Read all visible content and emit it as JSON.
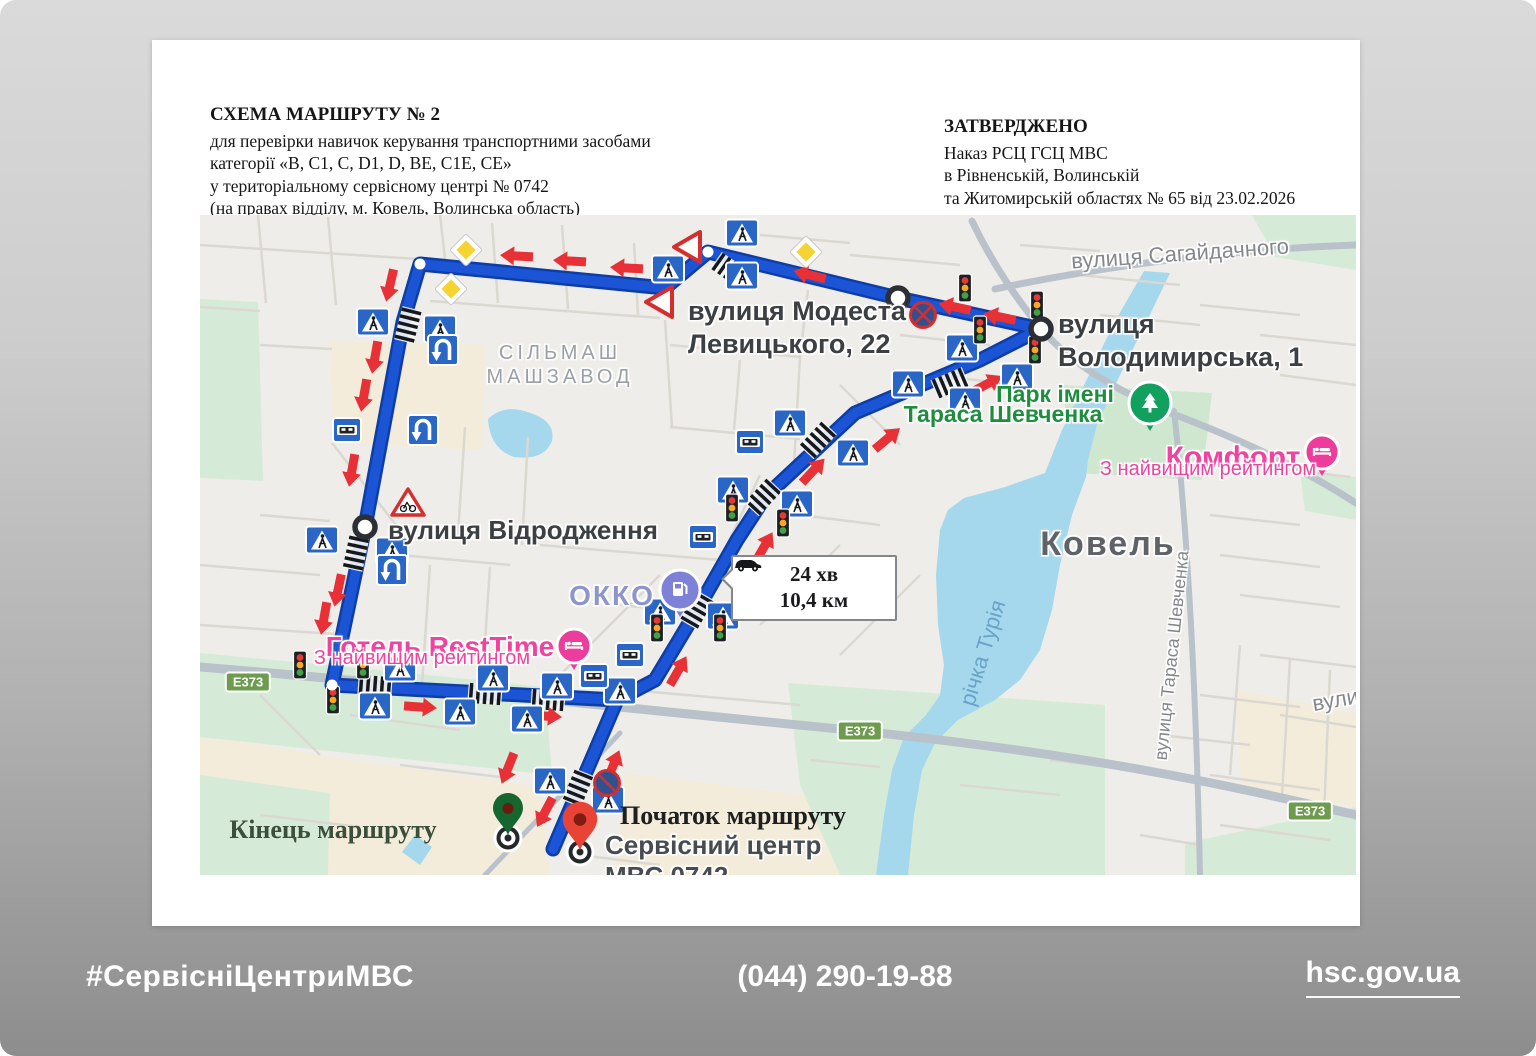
{
  "document": {
    "header": {
      "title": "СХЕМА МАРШРУТУ № 2",
      "line1": "для перевірки навичок керування транспортними засобами",
      "line2": "категорії «В, С1, С, D1, D, ВЕ, С1Е, СЕ»",
      "line3": "у територіальному сервісному центрі № 0742",
      "line4": "(на правах відділу, м. Ковель, Волинська область)"
    },
    "approval": {
      "title": "ЗАТВЕРДЖЕНО",
      "line1": "Наказ РСЦ ГСЦ МВС",
      "line2": "в Рівненській, Волинській",
      "line3": "та Житомирській областях № 65 від 23.02.2026"
    }
  },
  "footer": {
    "hashtag": "#СервісніЦентриМВС",
    "phone": "(044) 290-19-88",
    "site": "hsc.gov.ua"
  },
  "map": {
    "colors": {
      "base": "#efede9",
      "water": "#a5d8ec",
      "green": "#d6ebd7",
      "beige": "#f3ecda",
      "route": "#1b55d6",
      "route_casing": "#0d3ea8",
      "arrow": "#e73137",
      "sign_blue": "#2a66c6",
      "badge_green": "#6d9c4f",
      "poi_pink": "#ec3d9d",
      "poi_purple": "#7d82d8",
      "poi_green": "#12a05f",
      "pin_red": "#e84335",
      "pin_green": "#15662f"
    },
    "badge_text": "E373",
    "badges": [
      {
        "x": 48,
        "y": 467
      },
      {
        "x": 660,
        "y": 516
      },
      {
        "x": 1110,
        "y": 596
      }
    ],
    "tooltip": {
      "time": "24 хв",
      "dist": "10,4 км"
    },
    "labels": [
      {
        "name": "modesta-levytskoho",
        "lines": [
          "вулиця Модеста",
          "Левицького, 22"
        ],
        "x": 488,
        "y": 80,
        "size": 27,
        "lh": 33,
        "color": "#3c4043",
        "weight": 700,
        "halo": 1
      },
      {
        "name": "volodymyrska",
        "lines": [
          "вулиця",
          "Володимирська, 1"
        ],
        "x": 858,
        "y": 93,
        "size": 27,
        "lh": 33,
        "color": "#3c4043",
        "weight": 700,
        "halo": 1
      },
      {
        "name": "sahaidachnoho",
        "lines": [
          "вулиця Сагайдачного"
        ],
        "x": 980,
        "y": 26,
        "size": 22,
        "color": "#84878c",
        "weight": 400,
        "halo": 1,
        "center": 1,
        "rot": -4
      },
      {
        "name": "silmash-mashzavod",
        "lines": [
          "СІЛЬМАШ",
          "МАШЗАВОД"
        ],
        "x": 360,
        "y": 126,
        "size": 20,
        "lh": 24,
        "color": "#9aa0a6",
        "weight": 500,
        "halo": 1,
        "center": 1,
        "ls": 4
      },
      {
        "name": "vidrodzhennia",
        "lines": [
          "вулиця Відродження"
        ],
        "x": 188,
        "y": 300,
        "size": 26,
        "color": "#3c4043",
        "weight": 700,
        "halo": 1
      },
      {
        "name": "okko",
        "lines": [
          "ОККО"
        ],
        "x": 412,
        "y": 365,
        "size": 28,
        "color": "#8d96cc",
        "weight": 600,
        "halo": 1,
        "center": 1,
        "ls": 2
      },
      {
        "name": "hotel-resttime",
        "lines": [
          "Готель RestTime"
        ],
        "x": 240,
        "y": 416,
        "size": 28,
        "color": "#f0439f",
        "weight": 600,
        "halo": 1,
        "center": 1
      },
      {
        "name": "resttime-rating",
        "lines": [
          "З найвищим рейтингом"
        ],
        "x": 222,
        "y": 432,
        "size": 20,
        "color": "#f0439f",
        "weight": 500,
        "halo": 1,
        "center": 1
      },
      {
        "name": "park-imeni-1",
        "lines": [
          "Парк імені"
        ],
        "x": 855,
        "y": 166,
        "size": 23,
        "color": "#1e8e3e",
        "weight": 600,
        "halo": 1,
        "center": 1
      },
      {
        "name": "park-imeni-2",
        "lines": [
          "Тараса Шевченка"
        ],
        "x": 803,
        "y": 186,
        "size": 23,
        "color": "#1e8e3e",
        "weight": 600,
        "halo": 1,
        "center": 1
      },
      {
        "name": "komfort",
        "lines": [
          "Комфорт"
        ],
        "x": 1033,
        "y": 226,
        "size": 30,
        "color": "#f0439f",
        "weight": 600,
        "halo": 1,
        "center": 1
      },
      {
        "name": "komfort-rating",
        "lines": [
          "З найвищим рейтингом"
        ],
        "x": 1008,
        "y": 243,
        "size": 20,
        "color": "#f0439f",
        "weight": 500,
        "halo": 1,
        "center": 1
      },
      {
        "name": "kovel",
        "lines": [
          "Ковель"
        ],
        "x": 908,
        "y": 310,
        "size": 34,
        "color": "#5f6368",
        "weight": 600,
        "halo": 1,
        "center": 1,
        "ls": 2
      },
      {
        "name": "richka-turia",
        "lines": [
          "річка Турія"
        ],
        "x": 783,
        "y": 425,
        "size": 22,
        "color": "#6aa3c8",
        "weight": 500,
        "center": 1,
        "rot": -73
      },
      {
        "name": "taras-shevchenka-street",
        "lines": [
          "вулиця Тараса Шевченка"
        ],
        "x": 972,
        "y": 430,
        "size": 18,
        "color": "#84878c",
        "weight": 400,
        "halo": 1,
        "center": 1,
        "rot": -84
      },
      {
        "name": "vulytsia-edge",
        "lines": [
          "вулиця"
        ],
        "x": 1112,
        "y": 470,
        "size": 22,
        "color": "#84878c",
        "weight": 400,
        "halo": 1,
        "rot": -10
      },
      {
        "name": "kinets-marshrutu",
        "lines": [
          "Кінець маршруту"
        ],
        "x": 133,
        "y": 600,
        "size": 26,
        "color": "#3c4f3c",
        "weight": 700,
        "center": 1,
        "serif": 1
      },
      {
        "name": "pochatok-marshrutu",
        "lines": [
          "Початок маршруту"
        ],
        "x": 533,
        "y": 586,
        "size": 26,
        "color": "#1f1f1f",
        "weight": 700,
        "center": 1,
        "serif": 1
      },
      {
        "name": "service-center-0742",
        "lines": [
          "Сервісний центр",
          "МВС 0742"
        ],
        "x": 405,
        "y": 615,
        "size": 26,
        "lh": 31,
        "color": "#474c50",
        "weight": 700,
        "halo": 1
      }
    ],
    "signs": [
      {
        "t": "pc",
        "x": 542,
        "y": 18
      },
      {
        "t": "pc",
        "x": 468,
        "y": 54
      },
      {
        "t": "pc",
        "x": 542,
        "y": 61
      },
      {
        "t": "pc",
        "x": 173,
        "y": 107
      },
      {
        "t": "pc",
        "x": 240,
        "y": 114
      },
      {
        "t": "pc",
        "x": 122,
        "y": 325
      },
      {
        "t": "pc",
        "x": 192,
        "y": 336
      },
      {
        "t": "pc",
        "x": 200,
        "y": 453
      },
      {
        "t": "pc",
        "x": 293,
        "y": 463
      },
      {
        "t": "pc",
        "x": 357,
        "y": 471
      },
      {
        "t": "pc",
        "x": 420,
        "y": 476
      },
      {
        "t": "pc",
        "x": 175,
        "y": 491
      },
      {
        "t": "pc",
        "x": 260,
        "y": 497
      },
      {
        "t": "pc",
        "x": 327,
        "y": 504
      },
      {
        "t": "pc",
        "x": 460,
        "y": 397
      },
      {
        "t": "pc",
        "x": 523,
        "y": 401
      },
      {
        "t": "pc",
        "x": 533,
        "y": 275
      },
      {
        "t": "pc",
        "x": 597,
        "y": 289
      },
      {
        "t": "pc",
        "x": 590,
        "y": 208
      },
      {
        "t": "pc",
        "x": 653,
        "y": 238
      },
      {
        "t": "pc",
        "x": 708,
        "y": 169
      },
      {
        "t": "pc",
        "x": 817,
        "y": 162
      },
      {
        "t": "pc",
        "x": 765,
        "y": 186
      },
      {
        "t": "pc",
        "x": 762,
        "y": 133
      },
      {
        "t": "pc",
        "x": 350,
        "y": 566
      },
      {
        "t": "pc",
        "x": 408,
        "y": 585
      },
      {
        "t": "tl",
        "x": 765,
        "y": 73
      },
      {
        "t": "tl",
        "x": 837,
        "y": 90
      },
      {
        "t": "tl",
        "x": 780,
        "y": 115
      },
      {
        "t": "tl",
        "x": 835,
        "y": 135
      },
      {
        "t": "tl",
        "x": 532,
        "y": 293
      },
      {
        "t": "tl",
        "x": 583,
        "y": 308
      },
      {
        "t": "tl",
        "x": 457,
        "y": 413
      },
      {
        "t": "tl",
        "x": 520,
        "y": 413
      },
      {
        "t": "tl",
        "x": 100,
        "y": 450
      },
      {
        "t": "tl",
        "x": 163,
        "y": 450
      },
      {
        "t": "tl",
        "x": 133,
        "y": 485
      },
      {
        "t": "bus",
        "x": 147,
        "y": 215
      },
      {
        "t": "bus",
        "x": 550,
        "y": 227
      },
      {
        "t": "bus",
        "x": 503,
        "y": 322
      },
      {
        "t": "bus",
        "x": 430,
        "y": 440
      },
      {
        "t": "bus",
        "x": 394,
        "y": 461
      },
      {
        "t": "uturn",
        "x": 243,
        "y": 135
      },
      {
        "t": "uturn",
        "x": 223,
        "y": 215
      },
      {
        "t": "uturn",
        "x": 192,
        "y": 355
      },
      {
        "t": "yield",
        "x": 488,
        "y": 32,
        "r": 90
      },
      {
        "t": "yield",
        "x": 460,
        "y": 87,
        "r": 90
      },
      {
        "t": "prio",
        "x": 266,
        "y": 35
      },
      {
        "t": "prio",
        "x": 251,
        "y": 74
      },
      {
        "t": "prio",
        "x": 606,
        "y": 37
      },
      {
        "t": "nostop",
        "x": 723,
        "y": 100,
        "v": 1
      },
      {
        "t": "nostop",
        "x": 407,
        "y": 568,
        "v": 2
      },
      {
        "t": "bike",
        "x": 208,
        "y": 288
      }
    ],
    "arrows": [
      {
        "x": 317,
        "y": 41,
        "a": 183
      },
      {
        "x": 370,
        "y": 46,
        "a": 183
      },
      {
        "x": 427,
        "y": 53,
        "a": 183
      },
      {
        "x": 610,
        "y": 60,
        "a": 194
      },
      {
        "x": 755,
        "y": 92,
        "a": 192
      },
      {
        "x": 800,
        "y": 102,
        "a": 192
      },
      {
        "x": 190,
        "y": 70,
        "a": 103
      },
      {
        "x": 175,
        "y": 142,
        "a": 100
      },
      {
        "x": 164,
        "y": 180,
        "a": 100
      },
      {
        "x": 152,
        "y": 255,
        "a": 100
      },
      {
        "x": 138,
        "y": 375,
        "a": 102
      },
      {
        "x": 124,
        "y": 403,
        "a": 100
      },
      {
        "x": 220,
        "y": 492,
        "a": 4
      },
      {
        "x": 345,
        "y": 501,
        "a": 4
      },
      {
        "x": 413,
        "y": 551,
        "a": -68
      },
      {
        "x": 478,
        "y": 456,
        "a": -60
      },
      {
        "x": 564,
        "y": 332,
        "a": -60
      },
      {
        "x": 613,
        "y": 256,
        "a": -47
      },
      {
        "x": 687,
        "y": 224,
        "a": -40
      },
      {
        "x": 787,
        "y": 169,
        "a": -28
      },
      {
        "x": 308,
        "y": 553,
        "a": 112
      },
      {
        "x": 345,
        "y": 597,
        "a": 118
      }
    ],
    "crosswalks": [
      {
        "x": 530,
        "y": 55,
        "a": 35
      },
      {
        "x": 208,
        "y": 110,
        "a": 104
      },
      {
        "x": 156,
        "y": 338,
        "a": 102
      },
      {
        "x": 175,
        "y": 471,
        "a": 4
      },
      {
        "x": 285,
        "y": 479,
        "a": 4
      },
      {
        "x": 348,
        "y": 485,
        "a": 4
      },
      {
        "x": 497,
        "y": 395,
        "a": -60
      },
      {
        "x": 563,
        "y": 282,
        "a": -47
      },
      {
        "x": 618,
        "y": 225,
        "a": -47
      },
      {
        "x": 750,
        "y": 168,
        "a": -23
      },
      {
        "x": 378,
        "y": 573,
        "a": 112
      }
    ],
    "waypoints": [
      {
        "x": 698,
        "y": 83
      },
      {
        "x": 841,
        "y": 114
      },
      {
        "x": 165,
        "y": 312
      }
    ],
    "dots": [
      {
        "x": 220,
        "y": 49
      },
      {
        "x": 508,
        "y": 37
      },
      {
        "x": 132,
        "y": 470
      }
    ],
    "pois": [
      {
        "t": "fuel",
        "x": 480,
        "y": 375
      },
      {
        "t": "hotel",
        "x": 374,
        "y": 431
      },
      {
        "t": "tree",
        "x": 950,
        "y": 188
      },
      {
        "t": "hotel",
        "x": 1122,
        "y": 237
      }
    ],
    "markers": {
      "start_pin": {
        "x": 380,
        "y": 612
      },
      "end_pin": {
        "x": 308,
        "y": 600
      },
      "start_ring": {
        "x": 380,
        "y": 637
      },
      "end_ring": {
        "x": 308,
        "y": 623
      }
    }
  }
}
